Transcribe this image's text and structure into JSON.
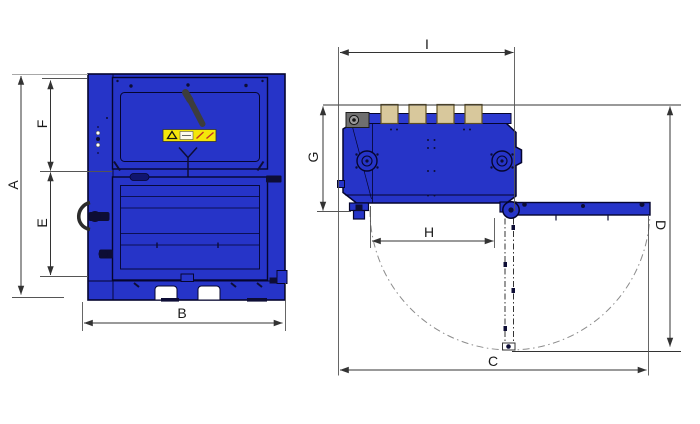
{
  "colors": {
    "bg": "#ffffff",
    "machine_blue": "#2634c8",
    "panel_blue": "#2c3ad0",
    "outline": "#05052e",
    "detail_dark": "#0d0d35",
    "tan": "#d8c89c",
    "tan_border": "#5f4f22",
    "warning_yellow": "#f4e60b",
    "gray_box": "#6f6f6f",
    "dim_line": "#333333",
    "ext_line": "#555555",
    "ref_line": "#a8a8a8",
    "arc_gray": "#8c8c8c",
    "handle_gray": "#3d3d3d",
    "white": "#ffffff"
  },
  "labels": {
    "A": "A",
    "B": "B",
    "C": "C",
    "D": "D",
    "E": "E",
    "F": "F",
    "G": "G",
    "H": "H",
    "I": "I"
  }
}
